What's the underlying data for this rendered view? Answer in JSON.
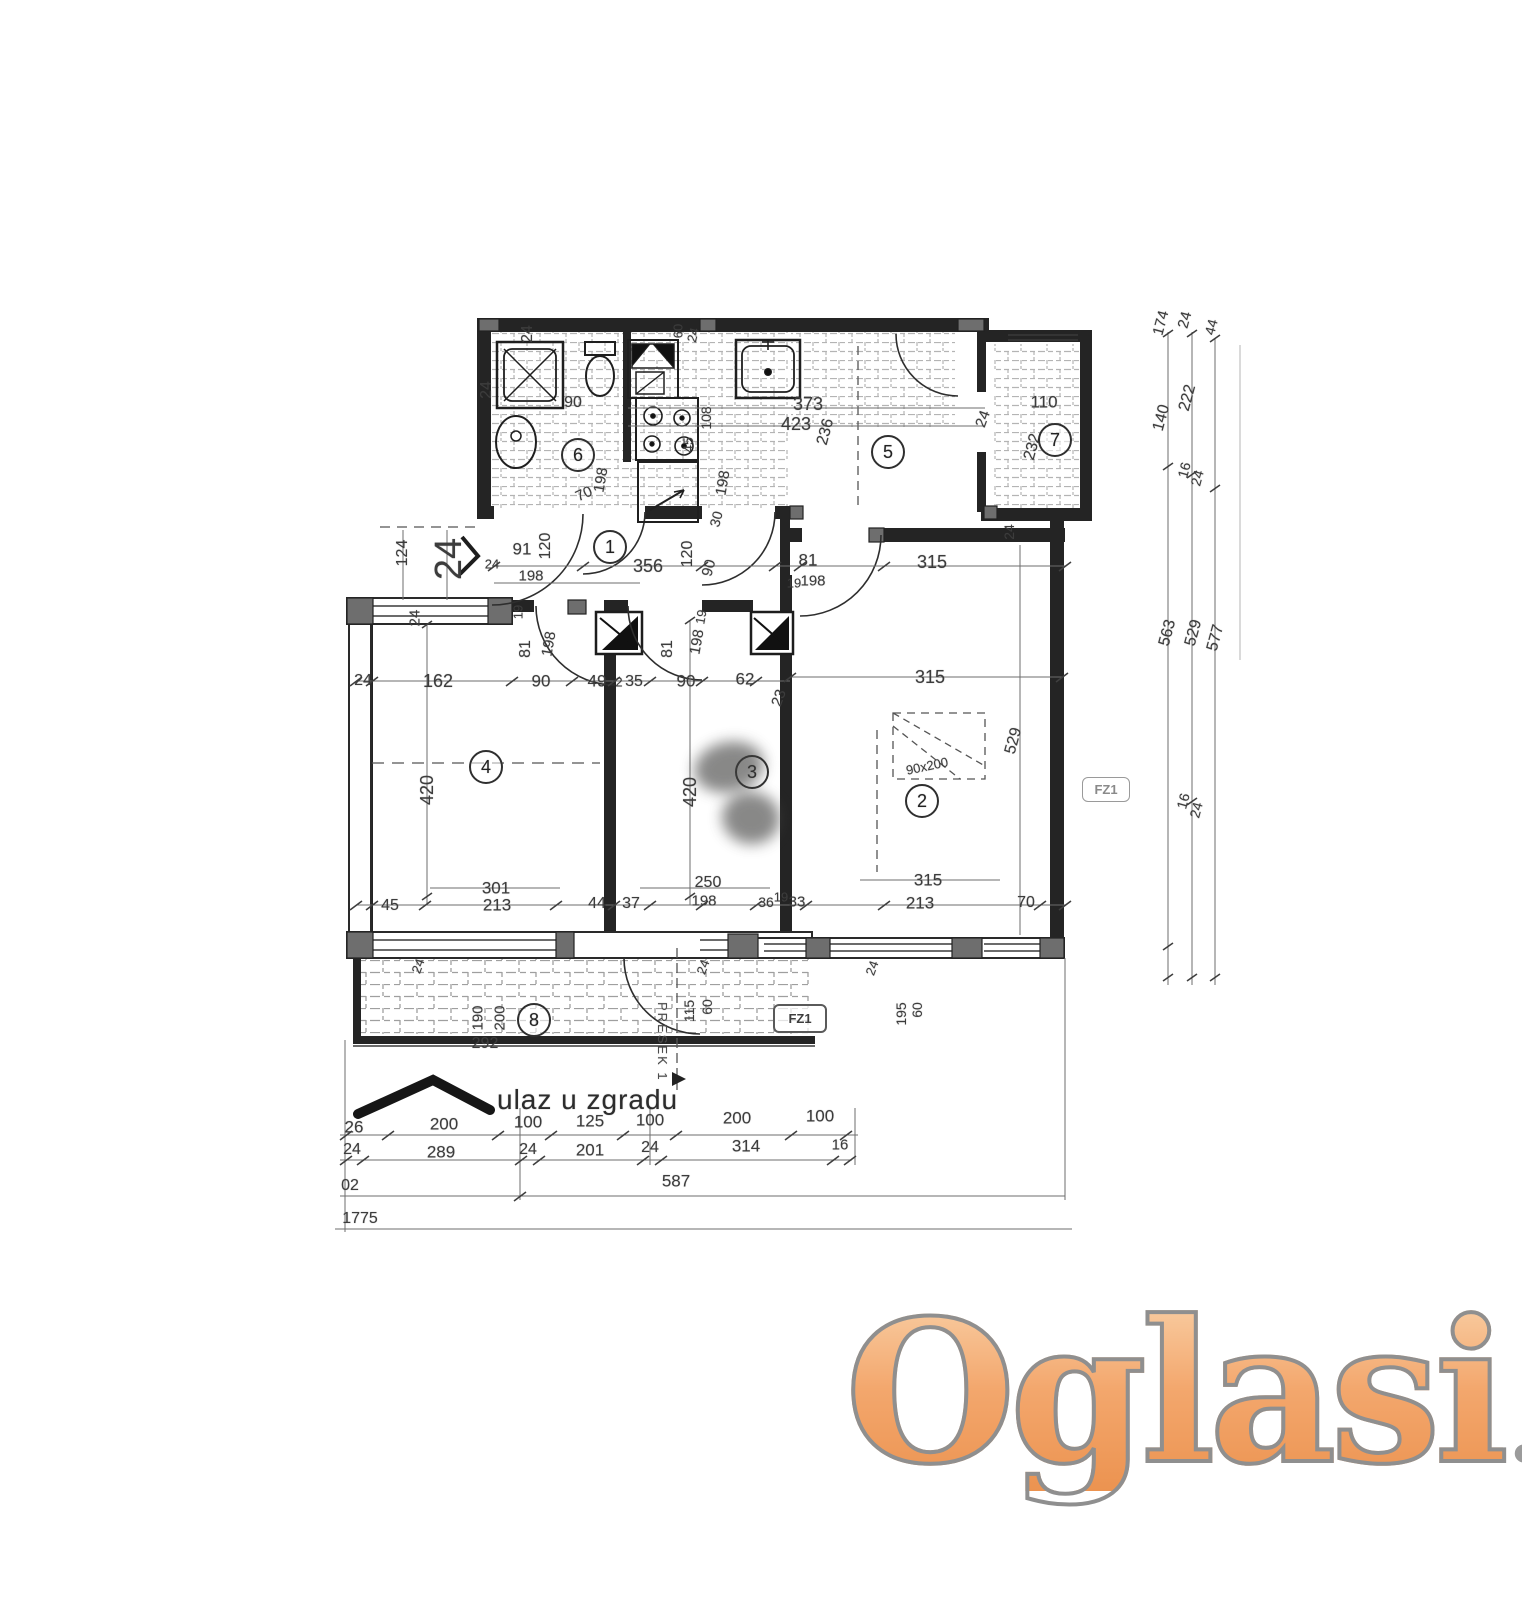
{
  "plan": {
    "entrance_label": "ulaz u zgradu",
    "section_label": "PRESEK 1",
    "fz1_bottom": "FZ1",
    "fz1_right": "FZ1"
  },
  "watermark": {
    "word": "Oglasi",
    "tld": ".rs",
    "word_color": "#f3a76d",
    "outline_color": "#8f8f8f",
    "tld_color": "#9b9b9b"
  },
  "rooms": [
    {
      "num": "1",
      "x": 610,
      "y": 547
    },
    {
      "num": "2",
      "x": 922,
      "y": 801
    },
    {
      "num": "3",
      "x": 752,
      "y": 772
    },
    {
      "num": "4",
      "x": 486,
      "y": 767
    },
    {
      "num": "5",
      "x": 888,
      "y": 452
    },
    {
      "num": "6",
      "x": 578,
      "y": 455
    },
    {
      "num": "7",
      "x": 1055,
      "y": 440
    },
    {
      "num": "8",
      "x": 534,
      "y": 1020
    }
  ],
  "dim_labels": [
    {
      "t": "24",
      "x": 528,
      "y": 334,
      "r": -90,
      "s": 16
    },
    {
      "t": "24",
      "x": 487,
      "y": 390,
      "r": -90,
      "s": 16
    },
    {
      "t": "90",
      "x": 573,
      "y": 403,
      "r": 0,
      "s": 16
    },
    {
      "t": "60",
      "x": 678,
      "y": 331,
      "r": -90,
      "s": 13
    },
    {
      "t": "24",
      "x": 693,
      "y": 335,
      "r": -75,
      "s": 13
    },
    {
      "t": "373",
      "x": 808,
      "y": 404,
      "r": 0,
      "s": 18
    },
    {
      "t": "423",
      "x": 796,
      "y": 424,
      "r": 0,
      "s": 18
    },
    {
      "t": "236",
      "x": 826,
      "y": 432,
      "r": -75,
      "s": 16
    },
    {
      "t": "108",
      "x": 706,
      "y": 418,
      "r": -90,
      "s": 14
    },
    {
      "t": "45",
      "x": 688,
      "y": 445,
      "r": -90,
      "s": 14
    },
    {
      "t": "198",
      "x": 601,
      "y": 480,
      "r": -80,
      "s": 15
    },
    {
      "t": "70",
      "x": 584,
      "y": 494,
      "r": -25,
      "s": 15
    },
    {
      "t": "198",
      "x": 723,
      "y": 483,
      "r": -80,
      "s": 15
    },
    {
      "t": "30",
      "x": 716,
      "y": 519,
      "r": -75,
      "s": 14
    },
    {
      "t": "110",
      "x": 1044,
      "y": 402,
      "r": 0,
      "s": 17
    },
    {
      "t": "232",
      "x": 1033,
      "y": 447,
      "r": -75,
      "s": 16
    },
    {
      "t": "24",
      "x": 983,
      "y": 419,
      "r": -70,
      "s": 15
    },
    {
      "t": "24",
      "x": 1009,
      "y": 532,
      "r": -90,
      "s": 14
    },
    {
      "t": "174",
      "x": 1161,
      "y": 323,
      "r": -75,
      "s": 15
    },
    {
      "t": "24",
      "x": 1185,
      "y": 320,
      "r": -75,
      "s": 15
    },
    {
      "t": "44",
      "x": 1211,
      "y": 327,
      "r": -75,
      "s": 14
    },
    {
      "t": "140",
      "x": 1162,
      "y": 418,
      "r": -75,
      "s": 16
    },
    {
      "t": "222",
      "x": 1188,
      "y": 398,
      "r": -75,
      "s": 16
    },
    {
      "t": "16",
      "x": 1184,
      "y": 470,
      "r": -75,
      "s": 14
    },
    {
      "t": "24",
      "x": 1197,
      "y": 478,
      "r": -75,
      "s": 14
    },
    {
      "t": "563",
      "x": 1168,
      "y": 633,
      "r": -75,
      "s": 16
    },
    {
      "t": "529",
      "x": 1194,
      "y": 633,
      "r": -75,
      "s": 16
    },
    {
      "t": "577",
      "x": 1216,
      "y": 638,
      "r": -75,
      "s": 16
    },
    {
      "t": "16",
      "x": 1183,
      "y": 801,
      "r": -75,
      "s": 14
    },
    {
      "t": "24",
      "x": 1196,
      "y": 810,
      "r": -75,
      "s": 14
    },
    {
      "t": "124",
      "x": 403,
      "y": 553,
      "r": -90,
      "s": 16
    },
    {
      "t": "24",
      "x": 449,
      "y": 559,
      "r": -90,
      "s": 38
    },
    {
      "t": "91",
      "x": 522,
      "y": 549,
      "r": 0,
      "s": 17
    },
    {
      "t": "120",
      "x": 546,
      "y": 546,
      "r": -90,
      "s": 16
    },
    {
      "t": "24",
      "x": 492,
      "y": 564,
      "r": 0,
      "s": 13
    },
    {
      "t": "198",
      "x": 531,
      "y": 576,
      "r": 0,
      "s": 15
    },
    {
      "t": "356",
      "x": 648,
      "y": 566,
      "r": 0,
      "s": 18
    },
    {
      "t": "120",
      "x": 688,
      "y": 554,
      "r": -90,
      "s": 16
    },
    {
      "t": "90",
      "x": 709,
      "y": 568,
      "r": -75,
      "s": 15
    },
    {
      "t": "81",
      "x": 808,
      "y": 560,
      "r": 0,
      "s": 17
    },
    {
      "t": "19",
      "x": 794,
      "y": 583,
      "r": 0,
      "s": 13
    },
    {
      "t": "198",
      "x": 813,
      "y": 581,
      "r": 0,
      "s": 15
    },
    {
      "t": "315",
      "x": 932,
      "y": 562,
      "r": 0,
      "s": 18
    },
    {
      "t": "24",
      "x": 415,
      "y": 618,
      "r": -90,
      "s": 15
    },
    {
      "t": "24",
      "x": 363,
      "y": 681,
      "r": 0,
      "s": 16
    },
    {
      "t": "162",
      "x": 438,
      "y": 681,
      "r": 0,
      "s": 18
    },
    {
      "t": "19",
      "x": 518,
      "y": 612,
      "r": -90,
      "s": 13
    },
    {
      "t": "81",
      "x": 526,
      "y": 649,
      "r": -90,
      "s": 16
    },
    {
      "t": "198",
      "x": 549,
      "y": 644,
      "r": -80,
      "s": 15
    },
    {
      "t": "90",
      "x": 541,
      "y": 681,
      "r": 0,
      "s": 17
    },
    {
      "t": "49",
      "x": 597,
      "y": 681,
      "r": 0,
      "s": 17
    },
    {
      "t": "2",
      "x": 619,
      "y": 682,
      "r": 0,
      "s": 13
    },
    {
      "t": "35",
      "x": 634,
      "y": 682,
      "r": 0,
      "s": 16
    },
    {
      "t": "81",
      "x": 668,
      "y": 649,
      "r": -90,
      "s": 16
    },
    {
      "t": "19",
      "x": 701,
      "y": 617,
      "r": -80,
      "s": 13
    },
    {
      "t": "198",
      "x": 697,
      "y": 642,
      "r": -80,
      "s": 15
    },
    {
      "t": "90",
      "x": 686,
      "y": 681,
      "r": 0,
      "s": 17
    },
    {
      "t": "62",
      "x": 745,
      "y": 679,
      "r": 0,
      "s": 17
    },
    {
      "t": "23",
      "x": 779,
      "y": 698,
      "r": -70,
      "s": 15
    },
    {
      "t": "315",
      "x": 930,
      "y": 677,
      "r": 0,
      "s": 18
    },
    {
      "t": "420",
      "x": 427,
      "y": 790,
      "r": -90,
      "s": 18
    },
    {
      "t": "420",
      "x": 690,
      "y": 792,
      "r": -90,
      "s": 18
    },
    {
      "t": "529",
      "x": 1014,
      "y": 741,
      "r": -75,
      "s": 16
    },
    {
      "t": "90x200",
      "x": 927,
      "y": 766,
      "r": -12,
      "s": 13
    },
    {
      "t": "301",
      "x": 496,
      "y": 888,
      "r": 0,
      "s": 17
    },
    {
      "t": "213",
      "x": 497,
      "y": 905,
      "r": 0,
      "s": 17
    },
    {
      "t": "45",
      "x": 390,
      "y": 906,
      "r": 0,
      "s": 16
    },
    {
      "t": "44",
      "x": 597,
      "y": 904,
      "r": 0,
      "s": 16
    },
    {
      "t": "37",
      "x": 631,
      "y": 904,
      "r": 0,
      "s": 16
    },
    {
      "t": "250",
      "x": 708,
      "y": 883,
      "r": 0,
      "s": 16
    },
    {
      "t": "198",
      "x": 704,
      "y": 901,
      "r": 0,
      "s": 15
    },
    {
      "t": "36",
      "x": 766,
      "y": 902,
      "r": 0,
      "s": 14
    },
    {
      "t": "19",
      "x": 781,
      "y": 897,
      "r": 0,
      "s": 13
    },
    {
      "t": "33",
      "x": 797,
      "y": 902,
      "r": 0,
      "s": 15
    },
    {
      "t": "315",
      "x": 928,
      "y": 880,
      "r": 0,
      "s": 17
    },
    {
      "t": "213",
      "x": 920,
      "y": 903,
      "r": 0,
      "s": 17
    },
    {
      "t": "70",
      "x": 1026,
      "y": 903,
      "r": 0,
      "s": 16
    },
    {
      "t": "24",
      "x": 418,
      "y": 966,
      "r": -70,
      "s": 13
    },
    {
      "t": "190",
      "x": 478,
      "y": 1018,
      "r": -90,
      "s": 15
    },
    {
      "t": "200",
      "x": 500,
      "y": 1018,
      "r": -90,
      "s": 15
    },
    {
      "t": "292",
      "x": 485,
      "y": 1044,
      "r": 0,
      "s": 16
    },
    {
      "t": "24",
      "x": 703,
      "y": 967,
      "r": -70,
      "s": 13
    },
    {
      "t": "115",
      "x": 689,
      "y": 1011,
      "r": -90,
      "s": 14
    },
    {
      "t": "60",
      "x": 707,
      "y": 1007,
      "r": -90,
      "s": 14
    },
    {
      "t": "24",
      "x": 872,
      "y": 968,
      "r": -70,
      "s": 13
    },
    {
      "t": "195",
      "x": 901,
      "y": 1014,
      "r": -90,
      "s": 14
    },
    {
      "t": "60",
      "x": 917,
      "y": 1010,
      "r": -90,
      "s": 14
    },
    {
      "t": "26",
      "x": 354,
      "y": 1127,
      "r": 0,
      "s": 17
    },
    {
      "t": "200",
      "x": 444,
      "y": 1124,
      "r": 0,
      "s": 17
    },
    {
      "t": "100",
      "x": 528,
      "y": 1122,
      "r": 0,
      "s": 17
    },
    {
      "t": "125",
      "x": 590,
      "y": 1121,
      "r": 0,
      "s": 17
    },
    {
      "t": "100",
      "x": 650,
      "y": 1120,
      "r": 0,
      "s": 17
    },
    {
      "t": "200",
      "x": 737,
      "y": 1118,
      "r": 0,
      "s": 17
    },
    {
      "t": "100",
      "x": 820,
      "y": 1116,
      "r": 0,
      "s": 17
    },
    {
      "t": "24",
      "x": 352,
      "y": 1150,
      "r": 0,
      "s": 16
    },
    {
      "t": "289",
      "x": 441,
      "y": 1152,
      "r": 0,
      "s": 17
    },
    {
      "t": "24",
      "x": 528,
      "y": 1150,
      "r": 0,
      "s": 16
    },
    {
      "t": "201",
      "x": 590,
      "y": 1150,
      "r": 0,
      "s": 17
    },
    {
      "t": "24",
      "x": 650,
      "y": 1148,
      "r": 0,
      "s": 16
    },
    {
      "t": "314",
      "x": 746,
      "y": 1146,
      "r": 0,
      "s": 17
    },
    {
      "t": "16",
      "x": 840,
      "y": 1145,
      "r": 0,
      "s": 15
    },
    {
      "t": "02",
      "x": 350,
      "y": 1186,
      "r": 0,
      "s": 16
    },
    {
      "t": "587",
      "x": 676,
      "y": 1181,
      "r": 0,
      "s": 17
    },
    {
      "t": "1775",
      "x": 360,
      "y": 1219,
      "r": 0,
      "s": 16
    }
  ]
}
